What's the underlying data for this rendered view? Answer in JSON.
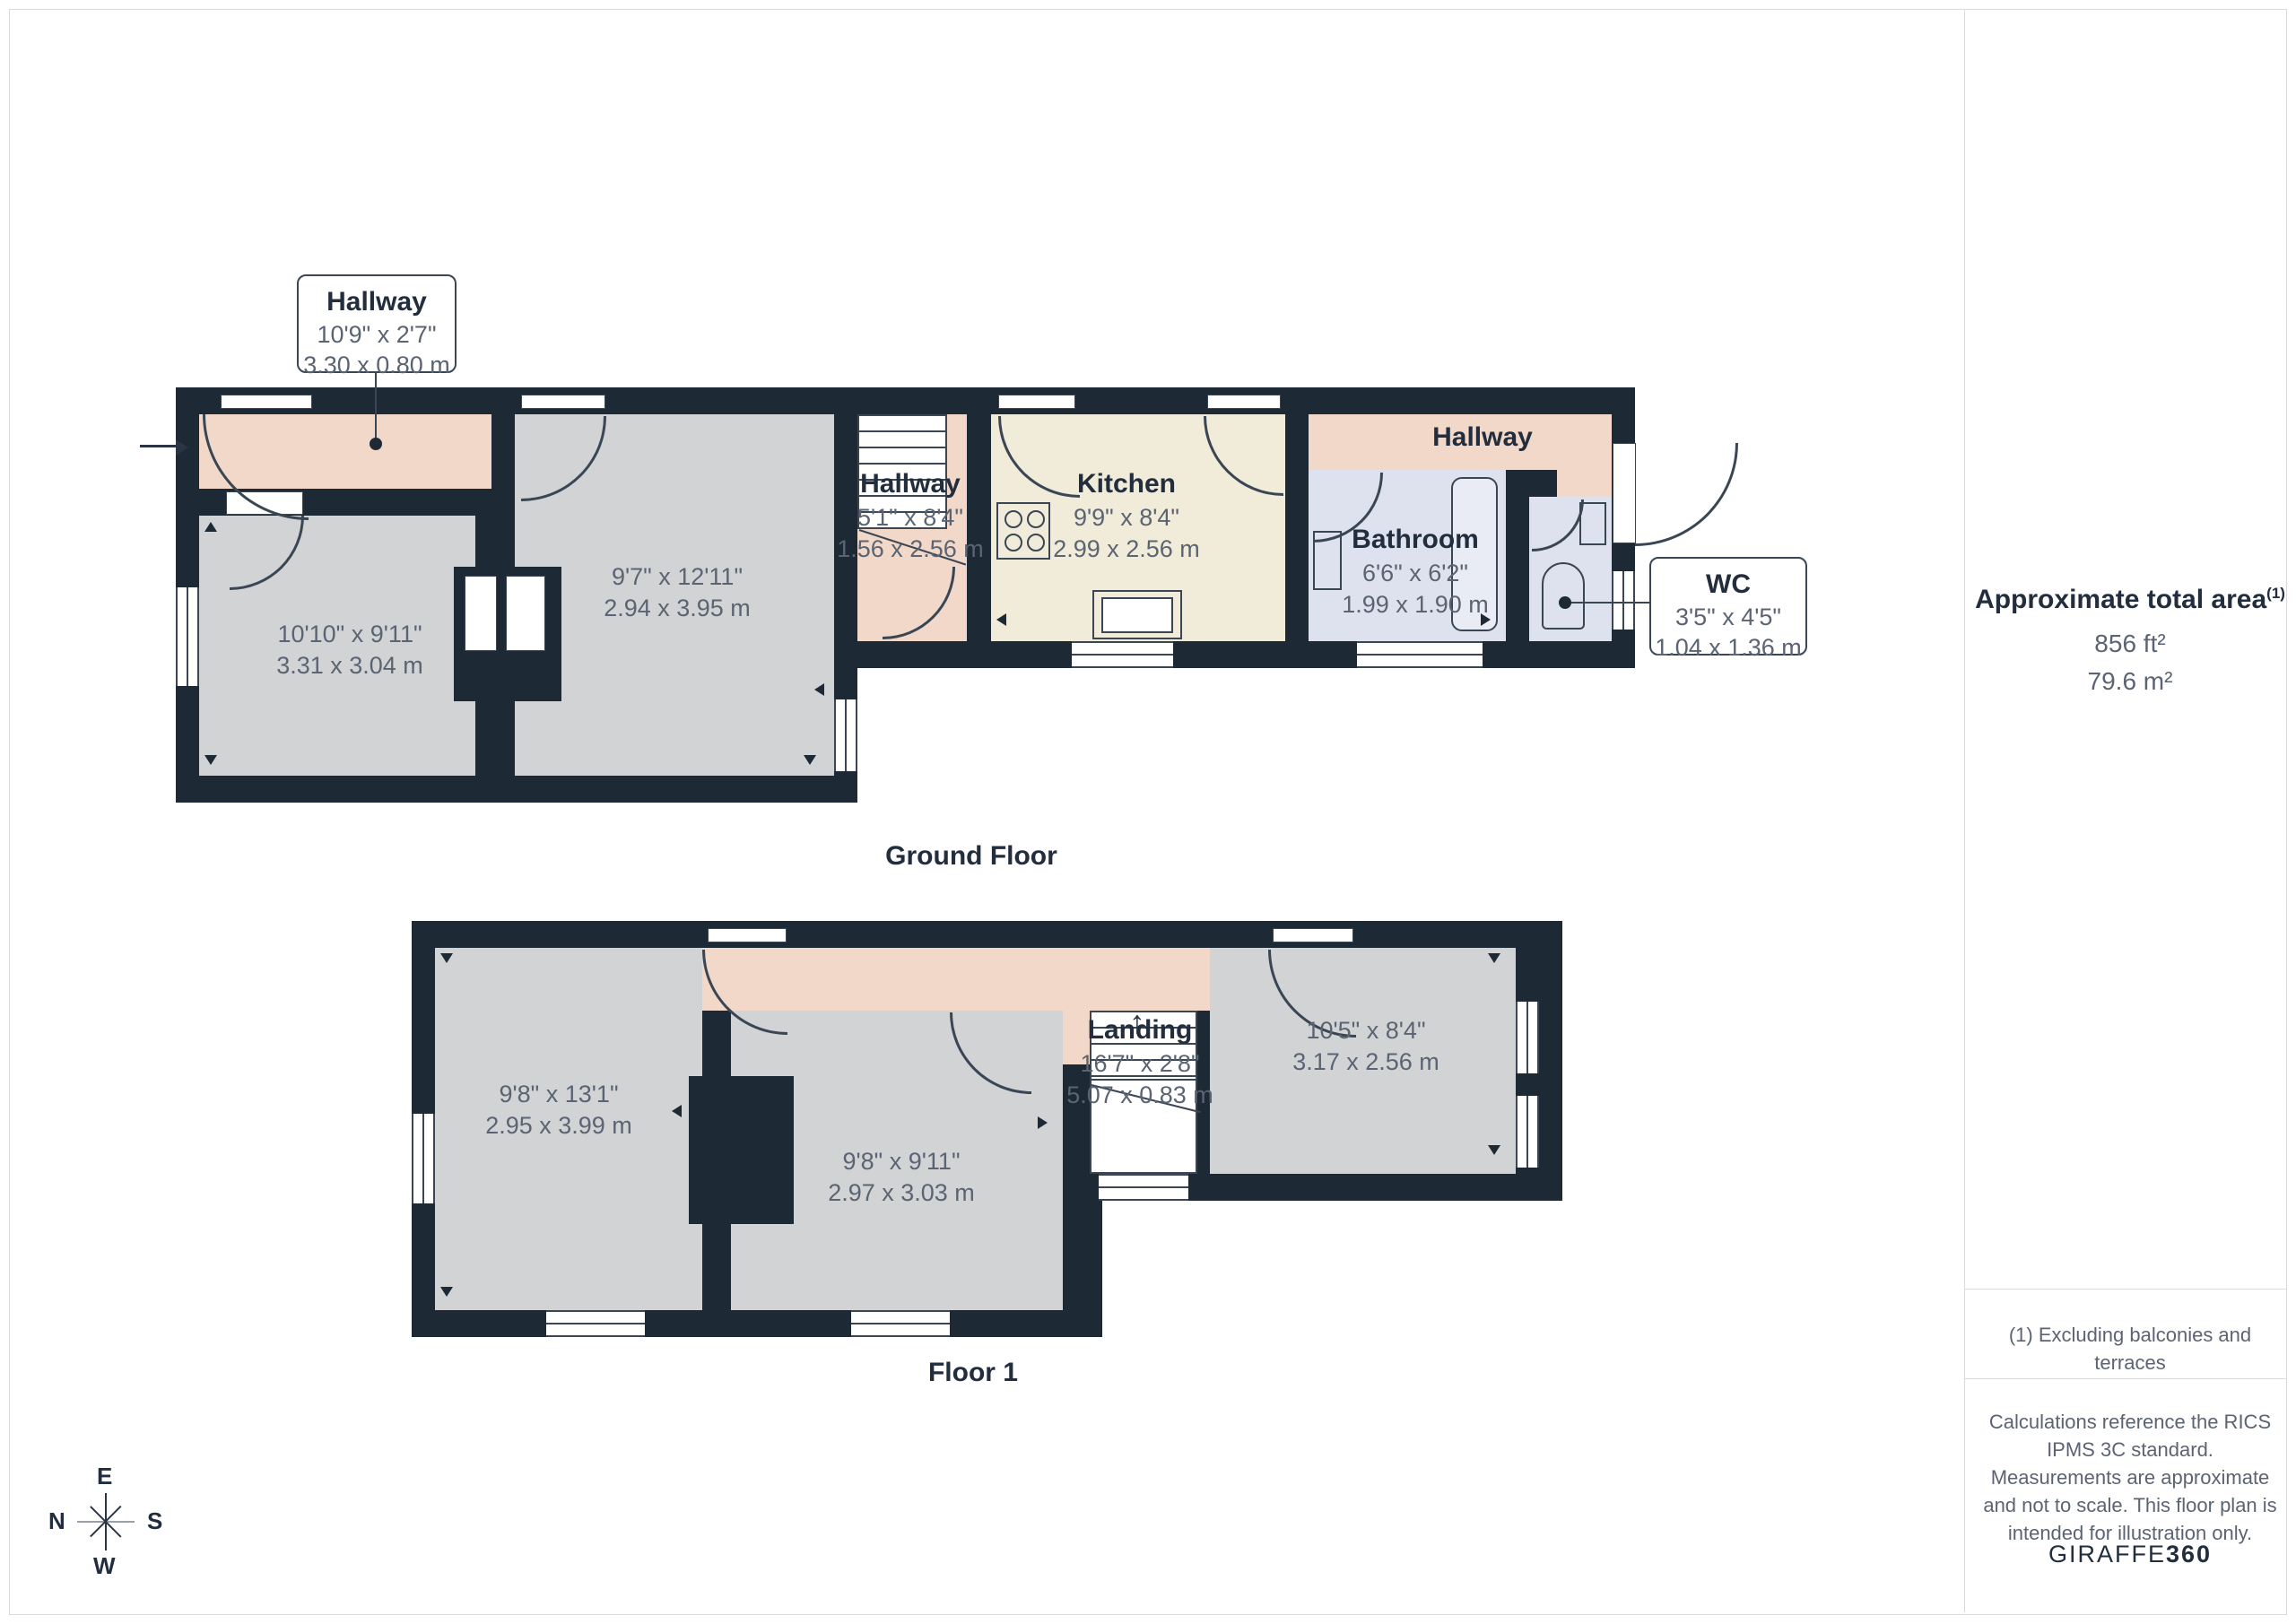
{
  "colors": {
    "wall": "#1e2936",
    "room": "#d2d3d5",
    "hall": "#f2d8c9",
    "kitchen": "#f1ebd9",
    "bath": "#dde2ee",
    "line": "#3a4654",
    "text_dark": "#222d3d",
    "text_gray": "#5b6472"
  },
  "gf": {
    "caption": "Ground Floor",
    "callout_hallway": {
      "title": "Hallway",
      "imp": "10'9\" x 2'7\"",
      "met": "3.30 x 0.80 m"
    },
    "callout_wc": {
      "title": "WC",
      "imp": "3'5\" x 4'5\"",
      "met": "1.04 x 1.36 m"
    },
    "room_left": {
      "imp": "10'10\" x 9'11\"",
      "met": "3.31 x 3.04 m"
    },
    "room_mid": {
      "imp": "9'7\" x 12'11\"",
      "met": "2.94 x 3.95 m"
    },
    "hall_stairs": {
      "title": "Hallway",
      "imp": "5'1\" x 8'4\"",
      "met": "1.56 x 2.56 m"
    },
    "kitchen": {
      "title": "Kitchen",
      "imp": "9'9\" x 8'4\"",
      "met": "2.99 x 2.56 m"
    },
    "hallway_right": {
      "title": "Hallway"
    },
    "bathroom": {
      "title": "Bathroom",
      "imp": "6'6\" x 6'2\"",
      "met": "1.99 x 1.90 m"
    }
  },
  "f1": {
    "caption": "Floor 1",
    "bed_left": {
      "imp": "9'8\" x 13'1\"",
      "met": "2.95 x 3.99 m"
    },
    "bed_mid": {
      "imp": "9'8\" x 9'11\"",
      "met": "2.97 x 3.03 m"
    },
    "landing": {
      "title": "Landing",
      "imp": "16'7\" x 2'8\"",
      "met": "5.07 x 0.83 m"
    },
    "bed_right": {
      "imp": "10'5\" x 8'4\"",
      "met": "3.17 x 2.56 m"
    }
  },
  "sidebar": {
    "area_title": "Approximate total area",
    "area_sup": "(1)",
    "area_imperial": "856 ft²",
    "area_metric": "79.6 m²",
    "footnote": "(1) Excluding balconies and terraces",
    "disclaimer": "Calculations reference the RICS IPMS 3C standard. Measurements are approximate and not to scale. This floor plan is intended for illustration only.",
    "brand_a": "GIRAFFE",
    "brand_b": "360"
  },
  "compass": {
    "top": "E",
    "left": "N",
    "right": "S",
    "bottom": "W"
  },
  "misc": {
    "stairs_up_arrow": "↑"
  }
}
